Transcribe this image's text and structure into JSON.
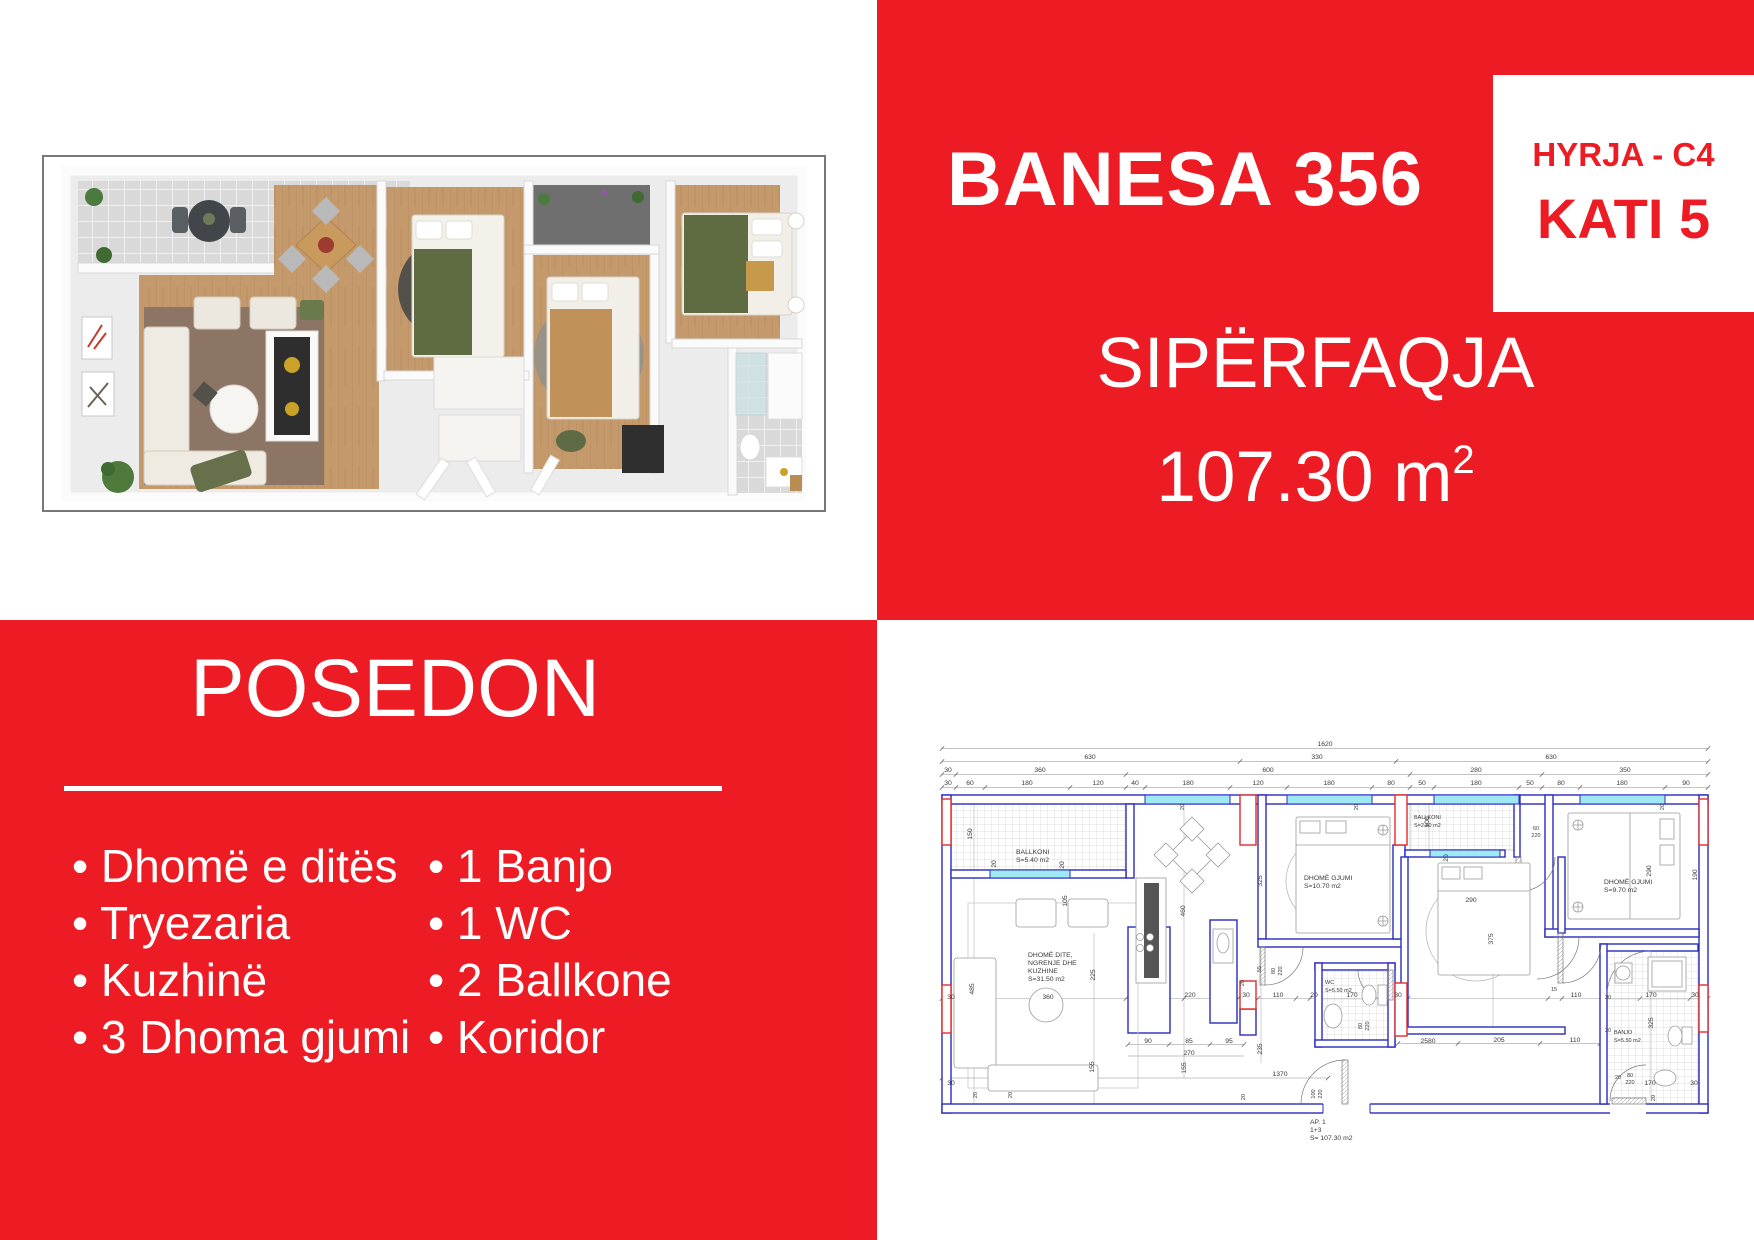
{
  "colors": {
    "red": "#ED1C24",
    "wall_blue": "#2B2BC0",
    "plan_red": "#E32A2A",
    "window_cyan": "#9FE9F4"
  },
  "unit": {
    "title": "BANESA 356",
    "entry": "HYRJA - C4",
    "floor": "KATI 5",
    "area_label": "SIPËRFAQJA",
    "area_value": "107.30 m",
    "area_exponent": "2"
  },
  "posedon": {
    "title": "POSEDON",
    "bullet": "•",
    "items_left": [
      "Dhomë e ditës",
      "Tryezaria",
      "Kuzhinë",
      "3 Dhoma gjumi"
    ],
    "items_right": [
      "1 Banjo",
      "1 WC",
      "2 Ballkone",
      "Koridor"
    ]
  },
  "plan": {
    "texts": [
      {
        "t": "1620",
        "x": 397,
        "y": 13
      },
      {
        "t": "630",
        "x": 162,
        "y": 26
      },
      {
        "t": "330",
        "x": 389,
        "y": 26
      },
      {
        "t": "630",
        "x": 623,
        "y": 26
      },
      {
        "t": "30",
        "x": 20,
        "y": 39
      },
      {
        "t": "360",
        "x": 112,
        "y": 39
      },
      {
        "t": "600",
        "x": 340,
        "y": 39
      },
      {
        "t": "280",
        "x": 548,
        "y": 39
      },
      {
        "t": "350",
        "x": 697,
        "y": 39
      },
      {
        "t": "30",
        "x": 20,
        "y": 52
      },
      {
        "t": "60",
        "x": 42,
        "y": 52
      },
      {
        "t": "180",
        "x": 99,
        "y": 52
      },
      {
        "t": "120",
        "x": 170,
        "y": 52
      },
      {
        "t": "40",
        "x": 207,
        "y": 52
      },
      {
        "t": "180",
        "x": 260,
        "y": 52
      },
      {
        "t": "120",
        "x": 330,
        "y": 52
      },
      {
        "t": "180",
        "x": 401,
        "y": 52
      },
      {
        "t": "80",
        "x": 463,
        "y": 52
      },
      {
        "t": "50",
        "x": 494,
        "y": 52
      },
      {
        "t": "180",
        "x": 548,
        "y": 52
      },
      {
        "t": "50",
        "x": 602,
        "y": 52
      },
      {
        "t": "80",
        "x": 633,
        "y": 52
      },
      {
        "t": "180",
        "x": 694,
        "y": 52
      },
      {
        "t": "90",
        "x": 758,
        "y": 52
      },
      {
        "t": "150",
        "x": 44,
        "y": 101,
        "r": -90
      },
      {
        "t": "20",
        "x": 68,
        "y": 131,
        "r": -90
      },
      {
        "t": "20",
        "x": 136,
        "y": 132,
        "r": -90
      },
      {
        "t": "105",
        "x": 139,
        "y": 168,
        "r": -90
      },
      {
        "t": "485",
        "x": 46,
        "y": 256,
        "r": -90
      },
      {
        "t": "460",
        "x": 257,
        "y": 178,
        "r": -90
      },
      {
        "t": "325",
        "x": 334,
        "y": 148,
        "r": -90
      },
      {
        "t": "225",
        "x": 167,
        "y": 242,
        "r": -90
      },
      {
        "t": "155",
        "x": 166,
        "y": 334,
        "r": -90
      },
      {
        "t": "100",
        "x": 501,
        "y": 89,
        "r": -90
      },
      {
        "t": "20",
        "x": 520,
        "y": 125,
        "r": -90
      },
      {
        "t": "60",
        "x": 608,
        "y": 97,
        "s": 5.5
      },
      {
        "t": "220",
        "x": 608,
        "y": 104,
        "s": 5.5
      },
      {
        "t": "290",
        "x": 543,
        "y": 169
      },
      {
        "t": "375",
        "x": 565,
        "y": 206,
        "r": -90
      },
      {
        "t": "290",
        "x": 723,
        "y": 138,
        "r": -90
      },
      {
        "t": "190",
        "x": 769,
        "y": 142,
        "r": -90
      },
      {
        "t": "20",
        "x": 256,
        "y": 74,
        "r": -90,
        "s": 5.5
      },
      {
        "t": "20",
        "x": 430,
        "y": 74,
        "r": -90,
        "s": 5.5
      },
      {
        "t": "20",
        "x": 736,
        "y": 74,
        "r": -90,
        "s": 5.5
      },
      {
        "t": "30",
        "x": 23,
        "y": 266
      },
      {
        "t": "360",
        "x": 120,
        "y": 266
      },
      {
        "t": "220",
        "x": 262,
        "y": 264
      },
      {
        "t": "30",
        "x": 318,
        "y": 264
      },
      {
        "t": "110",
        "x": 350,
        "y": 264
      },
      {
        "t": "20",
        "x": 386,
        "y": 264
      },
      {
        "t": "170",
        "x": 424,
        "y": 264
      },
      {
        "t": "30",
        "x": 470,
        "y": 264
      },
      {
        "t": "15",
        "x": 626,
        "y": 258,
        "s": 5.5
      },
      {
        "t": "110",
        "x": 648,
        "y": 264
      },
      {
        "t": "170",
        "x": 723,
        "y": 264
      },
      {
        "t": "30",
        "x": 767,
        "y": 264
      },
      {
        "t": "20",
        "x": 680,
        "y": 266,
        "s": 5.5
      },
      {
        "t": "55",
        "x": 333,
        "y": 236,
        "r": -90,
        "s": 5.5
      },
      {
        "t": "80",
        "x": 347,
        "y": 238,
        "r": -90,
        "s": 5.5
      },
      {
        "t": "220",
        "x": 354,
        "y": 238,
        "r": -90,
        "s": 5.5
      },
      {
        "t": "80",
        "x": 434,
        "y": 293,
        "r": -90,
        "s": 5.5
      },
      {
        "t": "220",
        "x": 441,
        "y": 293,
        "r": -90,
        "s": 5.5
      },
      {
        "t": "20",
        "x": 316,
        "y": 250,
        "r": -90,
        "s": 5.5
      },
      {
        "t": "90",
        "x": 220,
        "y": 310
      },
      {
        "t": "85",
        "x": 261,
        "y": 310
      },
      {
        "t": "95",
        "x": 301,
        "y": 310
      },
      {
        "t": "270",
        "x": 261,
        "y": 322
      },
      {
        "t": "235",
        "x": 334,
        "y": 316,
        "r": -90
      },
      {
        "t": "155",
        "x": 258,
        "y": 335,
        "r": -90
      },
      {
        "t": "2580",
        "x": 500,
        "y": 310
      },
      {
        "t": "205",
        "x": 571,
        "y": 309
      },
      {
        "t": "110",
        "x": 647,
        "y": 309
      },
      {
        "t": "1370",
        "x": 352,
        "y": 343
      },
      {
        "t": "20",
        "x": 317,
        "y": 364,
        "r": -90,
        "s": 5.5
      },
      {
        "t": "100",
        "x": 387,
        "y": 361,
        "r": -90,
        "s": 5.5
      },
      {
        "t": "220",
        "x": 394,
        "y": 361,
        "r": -90,
        "s": 5.5
      },
      {
        "t": "30",
        "x": 23,
        "y": 352
      },
      {
        "t": "20",
        "x": 49,
        "y": 362,
        "r": -90,
        "s": 5.5
      },
      {
        "t": "20",
        "x": 84,
        "y": 362,
        "r": -90,
        "s": 5.5
      },
      {
        "t": "20",
        "x": 690,
        "y": 346,
        "s": 5.5
      },
      {
        "t": "80",
        "x": 702,
        "y": 344,
        "s": 5.5
      },
      {
        "t": "220",
        "x": 702,
        "y": 351,
        "s": 5.5
      },
      {
        "t": "170",
        "x": 722,
        "y": 352
      },
      {
        "t": "30",
        "x": 766,
        "y": 352
      },
      {
        "t": "20",
        "x": 727,
        "y": 365,
        "r": -90,
        "s": 5.5
      },
      {
        "t": "325",
        "x": 725,
        "y": 290,
        "r": -90
      },
      {
        "t": "20",
        "x": 680,
        "y": 299,
        "s": 5.5
      },
      {
        "lines": [
          "BALLKONI",
          "S=5.40 m2"
        ],
        "x": 88,
        "y": 121,
        "a": "start"
      },
      {
        "lines": [
          "DHOMË DITE,",
          "NGRENJE DHE",
          "KUZHINE",
          "S=31.50 m2"
        ],
        "x": 100,
        "y": 224,
        "a": "start"
      },
      {
        "lines": [
          "DHOMË GJUMI",
          "S=10.70 m2"
        ],
        "x": 376,
        "y": 147,
        "a": "start"
      },
      {
        "lines": [
          "BALLKONI",
          "S=2.80 m2"
        ],
        "x": 486,
        "y": 86,
        "a": "start",
        "s": 5.5
      },
      {
        "lines": [
          "DHOMË GJUMI",
          "S=9.70 m2"
        ],
        "x": 676,
        "y": 151,
        "a": "start"
      },
      {
        "lines": [
          "WC",
          "S=5.50 m2"
        ],
        "x": 397,
        "y": 251,
        "a": "start",
        "s": 5.5
      },
      {
        "lines": [
          "BANJO",
          "S=5.50 m2"
        ],
        "x": 686,
        "y": 301,
        "a": "start",
        "s": 5.5
      },
      {
        "lines": [
          "AP. 1",
          "1+3",
          "S= 107.30 m2"
        ],
        "x": 382,
        "y": 391,
        "a": "start"
      }
    ]
  }
}
